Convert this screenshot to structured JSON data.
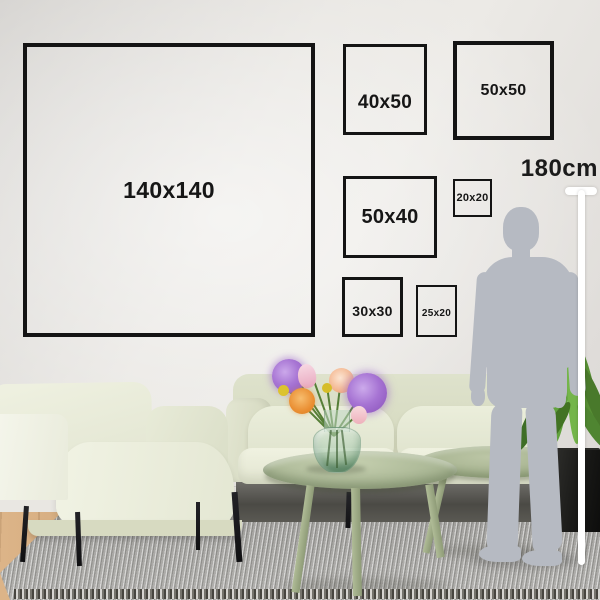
{
  "frames": [
    {
      "label": "140x140"
    },
    {
      "label": "40x50"
    },
    {
      "label": "50x50"
    },
    {
      "label": "50x40"
    },
    {
      "label": "20x20"
    },
    {
      "label": "30x30"
    },
    {
      "label": "25x20"
    }
  ],
  "height_reference": {
    "label": "180cm"
  },
  "colors": {
    "frame_border": "#141414",
    "label_text": "#161616",
    "wall": "#e8e6e3",
    "silhouette": "#b6bac2",
    "measure_line": "#ffffff",
    "sofa": "#e8ebd9",
    "table": "#a9b493",
    "rug": "#a5a4a1",
    "floor_wood": "#cba273",
    "plant_leaf": "#5e9a3a",
    "plant_pot": "#1b1b19",
    "flower_purple": "#a876d4",
    "flower_orange": "#ea8f33",
    "flower_peach": "#f3b48c",
    "flower_pink": "#eeb3bd",
    "flower_yellow": "#dcc32f"
  }
}
